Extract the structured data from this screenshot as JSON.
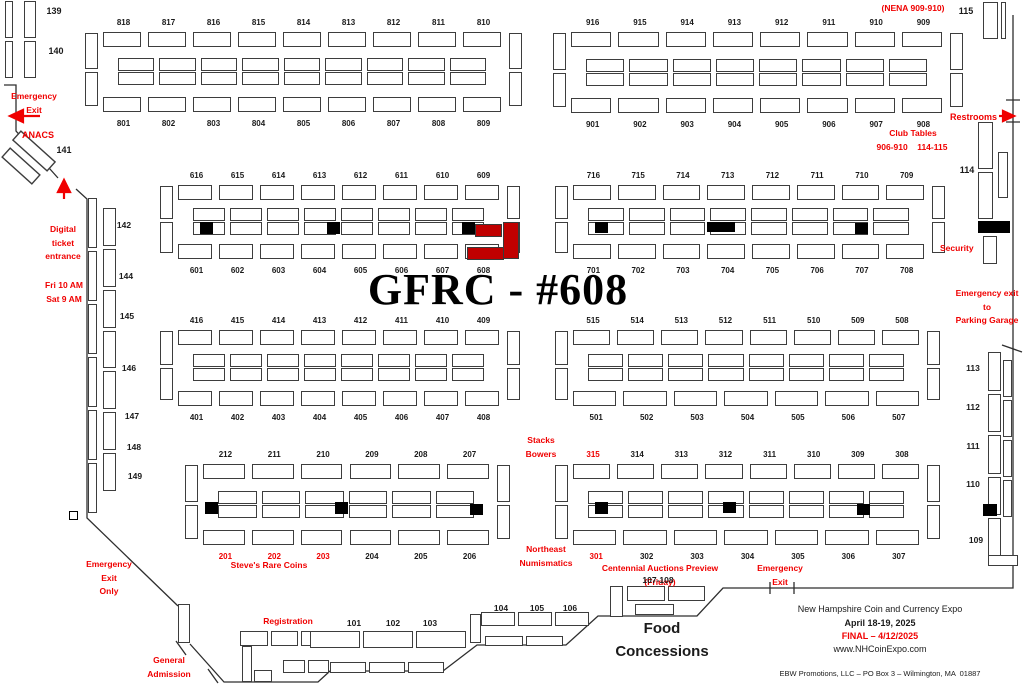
{
  "title": "GFRC - #608",
  "colors": {
    "red": "#f00000",
    "booth_red": "#c00000",
    "black": "#1a1a1a"
  },
  "islands": [
    {
      "id": "800",
      "x": 85,
      "y": 30,
      "w": 437,
      "h": 84,
      "top": [
        "818",
        "817",
        "816",
        "815",
        "814",
        "813",
        "812",
        "811",
        "810"
      ],
      "bottom": [
        "801",
        "802",
        "803",
        "804",
        "805",
        "806",
        "807",
        "808",
        "809"
      ],
      "extras": []
    },
    {
      "id": "900",
      "x": 553,
      "y": 30,
      "w": 410,
      "h": 85,
      "top": [
        "916",
        "915",
        "914",
        "913",
        "912",
        "911",
        "910",
        "909"
      ],
      "bottom": [
        "901",
        "902",
        "903",
        "904",
        "905",
        "906",
        "907",
        "908"
      ],
      "extras": []
    },
    {
      "id": "600",
      "x": 160,
      "y": 183,
      "w": 360,
      "h": 78,
      "top": [
        "616",
        "615",
        "614",
        "613",
        "612",
        "611",
        "610",
        "609"
      ],
      "bottom": [
        "601",
        "602",
        "603",
        "604",
        "605",
        "606",
        "607",
        "608"
      ],
      "extras": [
        {
          "t": "blk",
          "x": 40,
          "y": 39,
          "w": 13,
          "h": 12
        },
        {
          "t": "blk",
          "x": 167,
          "y": 39,
          "w": 13,
          "h": 12
        },
        {
          "t": "blk",
          "x": 302,
          "y": 39,
          "w": 13,
          "h": 12
        },
        {
          "t": "red",
          "x": 315,
          "y": 41,
          "w": 27,
          "h": 13
        },
        {
          "t": "red",
          "x": 343,
          "y": 39,
          "w": 16,
          "h": 37
        },
        {
          "t": "red",
          "x": 307,
          "y": 64,
          "w": 37,
          "h": 13
        }
      ]
    },
    {
      "id": "700",
      "x": 555,
      "y": 183,
      "w": 390,
      "h": 78,
      "top": [
        "716",
        "715",
        "714",
        "713",
        "712",
        "711",
        "710",
        "709"
      ],
      "bottom": [
        "701",
        "702",
        "703",
        "704",
        "705",
        "706",
        "707",
        "708"
      ],
      "extras": [
        {
          "t": "blk",
          "x": 40,
          "y": 39,
          "w": 13,
          "h": 11
        },
        {
          "t": "blk",
          "x": 152,
          "y": 39,
          "w": 28,
          "h": 10
        },
        {
          "t": "blk",
          "x": 300,
          "y": 40,
          "w": 13,
          "h": 11
        }
      ]
    },
    {
      "id": "400",
      "x": 160,
      "y": 328,
      "w": 360,
      "h": 80,
      "top": [
        "416",
        "415",
        "414",
        "413",
        "412",
        "411",
        "410",
        "409"
      ],
      "bottom": [
        "401",
        "402",
        "403",
        "404",
        "405",
        "406",
        "407",
        "408"
      ],
      "extras": []
    },
    {
      "id": "500",
      "x": 555,
      "y": 328,
      "w": 385,
      "h": 80,
      "top": [
        "515",
        "514",
        "513",
        "512",
        "511",
        "510",
        "509",
        "508"
      ],
      "bottom": [
        "501",
        "502",
        "503",
        "504",
        "505",
        "506",
        "507"
      ],
      "extras": []
    },
    {
      "id": "200",
      "x": 185,
      "y": 462,
      "w": 325,
      "h": 85,
      "top": [
        "212",
        "211",
        "210",
        "209",
        "208",
        "207"
      ],
      "bottom": [
        "201",
        "202",
        "203",
        "204",
        "205",
        "206"
      ],
      "extras": [
        {
          "t": "blk",
          "x": 20,
          "y": 40,
          "w": 13,
          "h": 12
        },
        {
          "t": "blk",
          "x": 150,
          "y": 40,
          "w": 13,
          "h": 12
        },
        {
          "t": "blk",
          "x": 285,
          "y": 42,
          "w": 13,
          "h": 11
        }
      ]
    },
    {
      "id": "300",
      "x": 555,
      "y": 462,
      "w": 385,
      "h": 85,
      "top": [
        "315",
        "314",
        "313",
        "312",
        "311",
        "310",
        "309",
        "308"
      ],
      "bottom": [
        "301",
        "302",
        "303",
        "304",
        "305",
        "306",
        "307"
      ],
      "extras": [
        {
          "t": "blk",
          "x": 40,
          "y": 40,
          "w": 13,
          "h": 12
        },
        {
          "t": "blk",
          "x": 168,
          "y": 40,
          "w": 13,
          "h": 11
        },
        {
          "t": "blk",
          "x": 302,
          "y": 42,
          "w": 13,
          "h": 11
        }
      ]
    }
  ],
  "red_booth_labels": [
    "315",
    "301",
    "201",
    "202",
    "203"
  ],
  "strips": [
    {
      "x": 5,
      "y": 1,
      "w": 8,
      "h": 77,
      "n": 2,
      "d": "v"
    },
    {
      "x": 24,
      "y": 1,
      "w": 12,
      "h": 77,
      "n": 2,
      "d": "v"
    },
    {
      "x": 983,
      "y": 2,
      "w": 15,
      "h": 37,
      "n": 1,
      "d": "v"
    },
    {
      "x": 1001,
      "y": 2,
      "w": 5,
      "h": 37,
      "n": 1,
      "d": "v"
    },
    {
      "x": 978,
      "y": 122,
      "w": 15,
      "h": 97,
      "n": 2,
      "d": "v"
    },
    {
      "x": 998,
      "y": 152,
      "w": 10,
      "h": 46,
      "n": 1,
      "d": "v"
    },
    {
      "x": 978,
      "y": 221,
      "w": 32,
      "h": 12,
      "n": 1,
      "d": "h",
      "cls": "blk"
    },
    {
      "x": 983,
      "y": 236,
      "w": 14,
      "h": 28,
      "n": 1,
      "d": "v"
    },
    {
      "x": 988,
      "y": 352,
      "w": 13,
      "h": 205,
      "n": 5,
      "d": "v"
    },
    {
      "x": 1003,
      "y": 360,
      "w": 9,
      "h": 157,
      "n": 4,
      "d": "v"
    },
    {
      "x": 983,
      "y": 504,
      "w": 14,
      "h": 12,
      "n": 1,
      "d": "h",
      "cls": "blk"
    },
    {
      "x": 988,
      "y": 555,
      "w": 30,
      "h": 11,
      "n": 1,
      "d": "h"
    },
    {
      "x": 88,
      "y": 198,
      "w": 9,
      "h": 315,
      "n": 6,
      "d": "v"
    },
    {
      "x": 103,
      "y": 208,
      "w": 13,
      "h": 283,
      "n": 7,
      "d": "v"
    },
    {
      "x": 69,
      "y": 511,
      "w": 9,
      "h": 9,
      "n": 1,
      "d": "h",
      "cls": "marker"
    },
    {
      "x": 178,
      "y": 604,
      "w": 12,
      "h": 39,
      "n": 1,
      "d": "v"
    },
    {
      "x": 240,
      "y": 631,
      "w": 89,
      "h": 15,
      "n": 3,
      "d": "h"
    },
    {
      "x": 242,
      "y": 646,
      "w": 10,
      "h": 36,
      "n": 1,
      "d": "v"
    },
    {
      "x": 254,
      "y": 670,
      "w": 18,
      "h": 12,
      "n": 1,
      "d": "h"
    },
    {
      "x": 283,
      "y": 660,
      "w": 46,
      "h": 13,
      "n": 2,
      "d": "h"
    },
    {
      "x": 310,
      "y": 631,
      "w": 156,
      "h": 17,
      "n": 3,
      "d": "h"
    },
    {
      "x": 330,
      "y": 662,
      "w": 114,
      "h": 11,
      "n": 3,
      "d": "h"
    },
    {
      "x": 470,
      "y": 614,
      "w": 11,
      "h": 29,
      "n": 1,
      "d": "v"
    },
    {
      "x": 481,
      "y": 612,
      "w": 108,
      "h": 14,
      "n": 3,
      "d": "h"
    },
    {
      "x": 485,
      "y": 636,
      "w": 78,
      "h": 10,
      "n": 2,
      "d": "h"
    },
    {
      "x": 610,
      "y": 586,
      "w": 13,
      "h": 31,
      "n": 1,
      "d": "v"
    },
    {
      "x": 627,
      "y": 586,
      "w": 78,
      "h": 15,
      "n": 2,
      "d": "h"
    },
    {
      "x": 635,
      "y": 604,
      "w": 39,
      "h": 11,
      "n": 1,
      "d": "h"
    }
  ],
  "annotations": [
    {
      "name": "nena-label",
      "lines": [
        "(NENA 909-910)"
      ],
      "x": 868,
      "y": 2,
      "w": 90,
      "color": "red"
    },
    {
      "name": "label-115",
      "lines": [
        "115"
      ],
      "x": 953,
      "y": 4,
      "w": 26,
      "color": "black",
      "size": 9
    },
    {
      "name": "restrooms-label",
      "lines": [
        "Restrooms"
      ],
      "x": 950,
      "y": 110,
      "w": 52,
      "color": "red",
      "size": 9,
      "align": "left"
    },
    {
      "name": "club-tables-label",
      "lines": [
        "Club Tables"
      ],
      "x": 868,
      "y": 127,
      "w": 90,
      "color": "red"
    },
    {
      "name": "club-tables-numbers",
      "lines": [
        "906-910    114-115"
      ],
      "x": 860,
      "y": 141,
      "w": 104,
      "color": "red"
    },
    {
      "name": "label-114",
      "lines": [
        "114"
      ],
      "x": 954,
      "y": 163,
      "w": 26,
      "color": "black",
      "size": 9
    },
    {
      "name": "security-label",
      "lines": [
        "Security"
      ],
      "x": 940,
      "y": 242,
      "w": 44,
      "color": "red",
      "align": "left"
    },
    {
      "name": "parking-exit-label",
      "lines": [
        "Emergency exit",
        "to",
        "Parking Garage"
      ],
      "x": 948,
      "y": 287,
      "w": 78,
      "color": "red"
    },
    {
      "name": "label-139",
      "lines": [
        "139"
      ],
      "x": 40,
      "y": 4,
      "w": 28,
      "color": "black",
      "size": 9
    },
    {
      "name": "label-140",
      "lines": [
        "140"
      ],
      "x": 42,
      "y": 44,
      "w": 28,
      "color": "black",
      "size": 9
    },
    {
      "name": "emergency-exit-left",
      "lines": [
        "Emergency",
        "Exit"
      ],
      "x": 6,
      "y": 90,
      "w": 56,
      "color": "red"
    },
    {
      "name": "anacs-label",
      "lines": [
        "ANACS"
      ],
      "x": 14,
      "y": 128,
      "w": 48,
      "color": "red",
      "size": 9
    },
    {
      "name": "label-141",
      "lines": [
        "141"
      ],
      "x": 50,
      "y": 143,
      "w": 28,
      "color": "black",
      "size": 9
    },
    {
      "name": "digital-entrance-label",
      "lines": [
        "Digital",
        "ticket",
        "entrance"
      ],
      "x": 34,
      "y": 223,
      "w": 58,
      "color": "red"
    },
    {
      "name": "hours-label",
      "lines": [
        "Fri 10 AM",
        "Sat 9 AM"
      ],
      "x": 36,
      "y": 279,
      "w": 56,
      "color": "red"
    },
    {
      "name": "label-142",
      "lines": [
        "142"
      ],
      "x": 112,
      "y": 219,
      "w": 24,
      "color": "black"
    },
    {
      "name": "label-144",
      "lines": [
        "144"
      ],
      "x": 114,
      "y": 270,
      "w": 24,
      "color": "black"
    },
    {
      "name": "label-145",
      "lines": [
        "145"
      ],
      "x": 115,
      "y": 310,
      "w": 24,
      "color": "black"
    },
    {
      "name": "label-146",
      "lines": [
        "146"
      ],
      "x": 117,
      "y": 362,
      "w": 24,
      "color": "black"
    },
    {
      "name": "label-147",
      "lines": [
        "147"
      ],
      "x": 120,
      "y": 410,
      "w": 24,
      "color": "black"
    },
    {
      "name": "label-148",
      "lines": [
        "148"
      ],
      "x": 122,
      "y": 441,
      "w": 24,
      "color": "black"
    },
    {
      "name": "label-149",
      "lines": [
        "149"
      ],
      "x": 123,
      "y": 470,
      "w": 24,
      "color": "black"
    },
    {
      "name": "label-113",
      "lines": [
        "113"
      ],
      "x": 961,
      "y": 362,
      "w": 24,
      "color": "black"
    },
    {
      "name": "label-112",
      "lines": [
        "112"
      ],
      "x": 961,
      "y": 401,
      "w": 24,
      "color": "black"
    },
    {
      "name": "label-111",
      "lines": [
        "111"
      ],
      "x": 961,
      "y": 440,
      "w": 24,
      "color": "black"
    },
    {
      "name": "label-110",
      "lines": [
        "110"
      ],
      "x": 961,
      "y": 478,
      "w": 24,
      "color": "black"
    },
    {
      "name": "label-109",
      "lines": [
        "109"
      ],
      "x": 964,
      "y": 534,
      "w": 24,
      "color": "black"
    },
    {
      "name": "stacks-bowers-label",
      "lines": [
        "Stacks",
        "Bowers"
      ],
      "x": 520,
      "y": 434,
      "w": 42,
      "color": "red"
    },
    {
      "name": "northeast-numismatics-label",
      "lines": [
        "Northeast",
        "Numismatics"
      ],
      "x": 516,
      "y": 543,
      "w": 60,
      "color": "red"
    },
    {
      "name": "steves-rare-coins-label",
      "lines": [
        "Steve's Rare Coins"
      ],
      "x": 222,
      "y": 559,
      "w": 94,
      "color": "red"
    },
    {
      "name": "centennial-label",
      "lines": [
        "Centennial Auctions Preview (Friday)"
      ],
      "x": 590,
      "y": 562,
      "w": 140,
      "color": "red"
    },
    {
      "name": "emergency-exit-bottom",
      "lines": [
        "Emergency",
        "Exit"
      ],
      "x": 754,
      "y": 562,
      "w": 52,
      "color": "red"
    },
    {
      "name": "general-admission-label",
      "lines": [
        "General",
        "Admission"
      ],
      "x": 142,
      "y": 654,
      "w": 54,
      "color": "red"
    },
    {
      "name": "emergency-exit-only",
      "lines": [
        "Emergency",
        "Exit",
        "Only"
      ],
      "x": 82,
      "y": 558,
      "w": 54,
      "color": "red"
    },
    {
      "name": "registration-label",
      "lines": [
        "Registration"
      ],
      "x": 258,
      "y": 615,
      "w": 60,
      "color": "red"
    },
    {
      "name": "label-101",
      "lines": [
        "101"
      ],
      "x": 340,
      "y": 617,
      "w": 28,
      "color": "black"
    },
    {
      "name": "label-102",
      "lines": [
        "102"
      ],
      "x": 379,
      "y": 617,
      "w": 28,
      "color": "black"
    },
    {
      "name": "label-103",
      "lines": [
        "103"
      ],
      "x": 416,
      "y": 617,
      "w": 28,
      "color": "black"
    },
    {
      "name": "label-104",
      "lines": [
        "104"
      ],
      "x": 487,
      "y": 602,
      "w": 28,
      "color": "black"
    },
    {
      "name": "label-105",
      "lines": [
        "105"
      ],
      "x": 523,
      "y": 602,
      "w": 28,
      "color": "black"
    },
    {
      "name": "label-106",
      "lines": [
        "106"
      ],
      "x": 556,
      "y": 602,
      "w": 28,
      "color": "black"
    },
    {
      "name": "label-107-108",
      "lines": [
        "107-108"
      ],
      "x": 638,
      "y": 574,
      "w": 40,
      "color": "black"
    },
    {
      "name": "food-concessions-label",
      "lines": [
        "Food",
        "Concessions"
      ],
      "x": 604,
      "y": 618,
      "w": 116,
      "color": "black",
      "size": 15,
      "lh": 1.5
    },
    {
      "name": "expo-name",
      "lines": [
        "New Hampshire Coin and Currency Expo"
      ],
      "x": 786,
      "y": 602,
      "w": 188,
      "color": "black",
      "size": 9,
      "bold": false
    },
    {
      "name": "expo-date",
      "lines": [
        "April 18-19, 2025"
      ],
      "x": 786,
      "y": 616,
      "w": 188,
      "color": "black",
      "size": 9
    },
    {
      "name": "expo-final",
      "lines": [
        "FINAL – 4/12/2025"
      ],
      "x": 786,
      "y": 629,
      "w": 188,
      "color": "red",
      "size": 9
    },
    {
      "name": "expo-url",
      "lines": [
        "www.NHCoinExpo.com"
      ],
      "x": 786,
      "y": 642,
      "w": 188,
      "color": "black",
      "size": 9,
      "bold": false
    },
    {
      "name": "expo-promoter",
      "lines": [
        "EBW Promotions, LLC – PO Box 3 – Wilmington, MA  01887"
      ],
      "x": 762,
      "y": 668,
      "w": 236,
      "color": "black",
      "size": 7.5,
      "bold": false
    }
  ]
}
